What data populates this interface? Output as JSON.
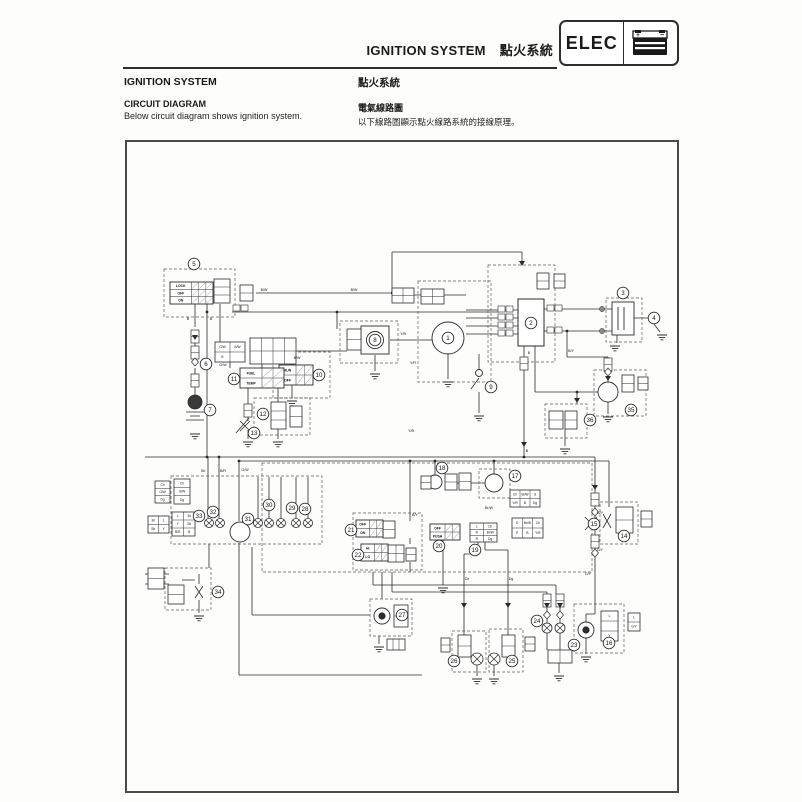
{
  "page": {
    "header": {
      "title_en": "IGNITION SYSTEM",
      "title_zh": "點火系統",
      "badge_label": "ELEC",
      "badge_icon": "battery-icon"
    },
    "intro": {
      "heading_en": "IGNITION SYSTEM",
      "subheading_en": "CIRCUIT DIAGRAM",
      "body_en": "Below circuit diagram shows ignition system.",
      "heading_zh": "點火系統",
      "subheading_zh": "電氣線路圖",
      "body_zh": "以下線路圖顯示點火線路系統的接線原理。"
    }
  },
  "diagram": {
    "ink": "#2b2b2b",
    "dash_color": "#5a5a5a",
    "callouts": [
      {
        "n": "1",
        "x": 446,
        "y": 336
      },
      {
        "n": "2",
        "x": 529,
        "y": 321
      },
      {
        "n": "3",
        "x": 621,
        "y": 291
      },
      {
        "n": "4",
        "x": 652,
        "y": 316
      },
      {
        "n": "5",
        "x": 192,
        "y": 262
      },
      {
        "n": "6",
        "x": 204,
        "y": 362
      },
      {
        "n": "7",
        "x": 208,
        "y": 408
      },
      {
        "n": "8",
        "x": 373,
        "y": 338
      },
      {
        "n": "9",
        "x": 489,
        "y": 385
      },
      {
        "n": "10",
        "x": 317,
        "y": 373
      },
      {
        "n": "11",
        "x": 232,
        "y": 377
      },
      {
        "n": "12",
        "x": 261,
        "y": 412
      },
      {
        "n": "13",
        "x": 252,
        "y": 431
      },
      {
        "n": "14",
        "x": 622,
        "y": 534
      },
      {
        "n": "15",
        "x": 592,
        "y": 522
      },
      {
        "n": "16",
        "x": 607,
        "y": 641
      },
      {
        "n": "17",
        "x": 513,
        "y": 474
      },
      {
        "n": "18",
        "x": 440,
        "y": 466
      },
      {
        "n": "19",
        "x": 473,
        "y": 548
      },
      {
        "n": "20",
        "x": 437,
        "y": 544
      },
      {
        "n": "21",
        "x": 349,
        "y": 528
      },
      {
        "n": "22",
        "x": 356,
        "y": 553
      },
      {
        "n": "23",
        "x": 572,
        "y": 643
      },
      {
        "n": "24",
        "x": 535,
        "y": 619
      },
      {
        "n": "25",
        "x": 510,
        "y": 659
      },
      {
        "n": "26",
        "x": 452,
        "y": 659
      },
      {
        "n": "27",
        "x": 400,
        "y": 613
      },
      {
        "n": "28",
        "x": 303,
        "y": 507
      },
      {
        "n": "29",
        "x": 290,
        "y": 506
      },
      {
        "n": "30",
        "x": 267,
        "y": 503
      },
      {
        "n": "31",
        "x": 246,
        "y": 517
      },
      {
        "n": "32",
        "x": 211,
        "y": 510
      },
      {
        "n": "33",
        "x": 197,
        "y": 514
      },
      {
        "n": "34",
        "x": 216,
        "y": 590
      },
      {
        "n": "35",
        "x": 629,
        "y": 408
      },
      {
        "n": "36",
        "x": 588,
        "y": 418
      }
    ],
    "switch_blocks": [
      {
        "x": 168,
        "y": 280,
        "w": 43,
        "h": 22,
        "rows": [
          "LOCK",
          "OFF",
          "ON"
        ],
        "cols": 3
      },
      {
        "x": 277,
        "y": 363,
        "w": 34,
        "h": 20,
        "rows": [
          "RUN",
          "OFF"
        ],
        "cols": 2
      },
      {
        "x": 238,
        "y": 366,
        "w": 44,
        "h": 20,
        "rows": [
          "FUEL",
          "TEMP"
        ],
        "cols": 2
      },
      {
        "x": 428,
        "y": 522,
        "w": 30,
        "h": 16,
        "rows": [
          "OFF",
          "PUSH"
        ],
        "cols": 2
      },
      {
        "x": 354,
        "y": 518,
        "w": 27,
        "h": 17,
        "rows": [
          "OFF",
          "ON"
        ],
        "cols": 2
      },
      {
        "x": 359,
        "y": 542,
        "w": 27,
        "h": 17,
        "rows": [
          "HI",
          "LO"
        ],
        "cols": 2
      }
    ],
    "grids": [
      {
        "x": 212,
        "y": 277,
        "w": 16,
        "h": 24,
        "c": 1,
        "r": 3
      },
      {
        "x": 238,
        "y": 283,
        "w": 13,
        "h": 16,
        "c": 1,
        "r": 2
      },
      {
        "x": 213,
        "y": 340,
        "w": 30,
        "h": 20,
        "c": 2,
        "r": 2,
        "labels": [
          "G/W",
          "B/W",
          "B",
          ""
        ]
      },
      {
        "x": 248,
        "y": 336,
        "w": 46,
        "h": 26,
        "c": 4,
        "r": 2
      },
      {
        "x": 390,
        "y": 286,
        "w": 22,
        "h": 15,
        "c": 2,
        "r": 2
      },
      {
        "x": 419,
        "y": 287,
        "w": 23,
        "h": 15,
        "c": 2,
        "r": 2
      },
      {
        "x": 345,
        "y": 327,
        "w": 14,
        "h": 21,
        "c": 1,
        "r": 2
      },
      {
        "x": 535,
        "y": 271,
        "w": 12,
        "h": 16,
        "c": 1,
        "r": 2
      },
      {
        "x": 552,
        "y": 272,
        "w": 11,
        "h": 14,
        "c": 1,
        "r": 2
      },
      {
        "x": 443,
        "y": 472,
        "w": 12,
        "h": 16,
        "c": 1,
        "r": 2
      },
      {
        "x": 457,
        "y": 471,
        "w": 12,
        "h": 17,
        "c": 1,
        "r": 2
      },
      {
        "x": 419,
        "y": 474,
        "w": 10,
        "h": 13,
        "c": 1,
        "r": 2
      },
      {
        "x": 508,
        "y": 488,
        "w": 30,
        "h": 17,
        "c": 3,
        "r": 2,
        "labels": [
          "Ch",
          "Br/W",
          "G",
          "Y/R",
          "B",
          "Dg"
        ]
      },
      {
        "x": 510,
        "y": 516,
        "w": 31,
        "h": 20,
        "c": 3,
        "r": 2,
        "labels": [
          "O",
          "Br/W",
          "Ch",
          "P",
          "B",
          "Y/R"
        ]
      },
      {
        "x": 468,
        "y": 521,
        "w": 27,
        "h": 19,
        "c": 2,
        "r": 3,
        "labels": [
          "L",
          "Ch",
          "N",
          "Br/W",
          "R",
          "Dg"
        ]
      },
      {
        "x": 381,
        "y": 519,
        "w": 12,
        "h": 17,
        "c": 1,
        "r": 2
      },
      {
        "x": 386,
        "y": 543,
        "w": 16,
        "h": 17,
        "c": 2,
        "r": 2
      },
      {
        "x": 404,
        "y": 546,
        "w": 10,
        "h": 13,
        "c": 1,
        "r": 2
      },
      {
        "x": 153,
        "y": 479,
        "w": 15,
        "h": 22,
        "c": 1,
        "r": 3,
        "labels": [
          "Ch",
          "G/W",
          "Dg"
        ]
      },
      {
        "x": 172,
        "y": 477,
        "w": 16,
        "h": 25,
        "c": 1,
        "r": 3,
        "labels": [
          "Ch",
          "G/W",
          "Dg"
        ]
      },
      {
        "x": 146,
        "y": 514,
        "w": 21,
        "h": 17,
        "c": 2,
        "r": 2,
        "labels": [
          "Br",
          "L",
          "Sb",
          "Y"
        ]
      },
      {
        "x": 170,
        "y": 510,
        "w": 23,
        "h": 24,
        "c": 2,
        "r": 3,
        "labels": [
          "L",
          "Br",
          "Y",
          "Sb",
          "B/R",
          "B"
        ]
      },
      {
        "x": 146,
        "y": 566,
        "w": 16,
        "h": 21,
        "c": 1,
        "r": 2
      },
      {
        "x": 166,
        "y": 583,
        "w": 16,
        "h": 19,
        "c": 1,
        "r": 2
      },
      {
        "x": 614,
        "y": 505,
        "w": 17,
        "h": 26,
        "c": 1,
        "r": 2
      },
      {
        "x": 639,
        "y": 509,
        "w": 11,
        "h": 16,
        "c": 1,
        "r": 2
      },
      {
        "x": 599,
        "y": 609,
        "w": 17,
        "h": 30,
        "c": 1,
        "r": 3,
        "labels": [
          "L",
          "",
          "Y"
        ]
      },
      {
        "x": 626,
        "y": 611,
        "w": 12,
        "h": 18,
        "c": 1,
        "r": 2,
        "labels": [
          "L",
          "G/Y"
        ]
      },
      {
        "x": 620,
        "y": 373,
        "w": 12,
        "h": 17,
        "c": 1,
        "r": 2
      },
      {
        "x": 636,
        "y": 375,
        "w": 10,
        "h": 13,
        "c": 1,
        "r": 2
      },
      {
        "x": 547,
        "y": 409,
        "w": 14,
        "h": 18,
        "c": 1,
        "r": 2
      },
      {
        "x": 563,
        "y": 409,
        "w": 12,
        "h": 18,
        "c": 1,
        "r": 2
      },
      {
        "x": 500,
        "y": 633,
        "w": 13,
        "h": 22,
        "c": 1,
        "r": 2
      },
      {
        "x": 523,
        "y": 635,
        "w": 10,
        "h": 14,
        "c": 1,
        "r": 2
      },
      {
        "x": 456,
        "y": 633,
        "w": 13,
        "h": 22,
        "c": 1,
        "r": 2
      },
      {
        "x": 439,
        "y": 636,
        "w": 9,
        "h": 14,
        "c": 1,
        "r": 2
      },
      {
        "x": 392,
        "y": 603,
        "w": 14,
        "h": 22,
        "c": 1,
        "r": 2
      },
      {
        "x": 546,
        "y": 648,
        "w": 24,
        "h": 13,
        "c": 2,
        "r": 1
      },
      {
        "x": 269,
        "y": 400,
        "w": 15,
        "h": 27,
        "c": 1,
        "r": 3
      },
      {
        "x": 288,
        "y": 404,
        "w": 12,
        "h": 21,
        "c": 1,
        "r": 2
      },
      {
        "x": 385,
        "y": 637,
        "w": 18,
        "h": 11,
        "c": 3,
        "r": 1
      }
    ],
    "dashed_boxes": [
      [
        162,
        267,
        71,
        48
      ],
      [
        486,
        263,
        67,
        97
      ],
      [
        604,
        296,
        36,
        44
      ],
      [
        416,
        279,
        73,
        101
      ],
      [
        338,
        319,
        58,
        42
      ],
      [
        271,
        350,
        57,
        46
      ],
      [
        252,
        396,
        56,
        37
      ],
      [
        169,
        474,
        151,
        68
      ],
      [
        260,
        461,
        330,
        109
      ],
      [
        351,
        511,
        69,
        57
      ],
      [
        477,
        467,
        31,
        29
      ],
      [
        598,
        500,
        38,
        42
      ],
      [
        572,
        602,
        50,
        49
      ],
      [
        592,
        368,
        52,
        46
      ],
      [
        543,
        402,
        42,
        34
      ],
      [
        487,
        627,
        34,
        43
      ],
      [
        450,
        629,
        34,
        41
      ],
      [
        368,
        597,
        42,
        37
      ],
      [
        163,
        566,
        46,
        42
      ]
    ],
    "bulbs_x": [
      [
        207,
        521,
        4.5
      ],
      [
        218,
        521,
        4.5
      ],
      [
        256,
        521,
        4.5
      ],
      [
        267,
        521,
        4.5
      ],
      [
        279,
        521,
        4.5
      ],
      [
        294,
        521,
        4.5
      ],
      [
        306,
        521,
        4.5
      ],
      [
        475,
        657,
        6
      ],
      [
        492,
        657,
        6
      ],
      [
        545,
        626,
        5
      ],
      [
        558,
        626,
        5
      ]
    ],
    "bulbs_fil": [
      [
        584,
        628,
        8
      ],
      [
        380,
        614,
        8
      ]
    ],
    "comp_circles": [
      [
        446,
        336,
        16
      ],
      [
        373,
        338,
        8.5
      ],
      [
        492,
        481,
        9
      ],
      [
        433,
        480,
        7
      ],
      [
        606,
        390,
        10
      ],
      [
        238,
        530,
        10
      ],
      [
        477,
        371,
        3.5
      ]
    ],
    "battery": [
      193,
      400,
      7
    ],
    "grounds": [
      [
        193,
        432
      ],
      [
        246,
        440
      ],
      [
        276,
        440
      ],
      [
        290,
        399
      ],
      [
        373,
        372
      ],
      [
        446,
        380
      ],
      [
        477,
        414
      ],
      [
        613,
        344
      ],
      [
        660,
        333
      ],
      [
        606,
        415
      ],
      [
        563,
        447
      ],
      [
        197,
        614
      ],
      [
        441,
        586
      ],
      [
        377,
        645
      ],
      [
        475,
        677
      ],
      [
        492,
        677
      ],
      [
        557,
        674
      ],
      [
        584,
        655
      ]
    ],
    "diamonds": [
      [
        193,
        360
      ],
      [
        606,
        370
      ],
      [
        593,
        510
      ],
      [
        593,
        551
      ],
      [
        545,
        613
      ],
      [
        558,
        613
      ]
    ],
    "fuses": [
      [
        189,
        328
      ],
      [
        189,
        344
      ],
      [
        189,
        372
      ],
      [
        518,
        355
      ],
      [
        602,
        356
      ],
      [
        589,
        491
      ],
      [
        589,
        533
      ],
      [
        541,
        592
      ],
      [
        554,
        592
      ],
      [
        242,
        402
      ]
    ],
    "arrows": [
      [
        520,
        259
      ],
      [
        193,
        333
      ],
      [
        522,
        440
      ],
      [
        593,
        483
      ],
      [
        545,
        601
      ],
      [
        558,
        601
      ],
      [
        462,
        601
      ],
      [
        506,
        601
      ],
      [
        606,
        374
      ],
      [
        575,
        396
      ]
    ],
    "dots": [
      [
        205,
        310
      ],
      [
        335,
        310
      ],
      [
        390,
        291
      ],
      [
        205,
        455
      ],
      [
        217,
        455
      ],
      [
        237,
        459
      ],
      [
        522,
        455
      ],
      [
        565,
        329
      ],
      [
        575,
        390
      ],
      [
        433,
        459
      ],
      [
        408,
        459
      ],
      [
        492,
        459
      ]
    ],
    "pair_squares": [
      [
        496,
        304
      ],
      [
        504,
        304
      ],
      [
        496,
        312
      ],
      [
        504,
        312
      ],
      [
        496,
        320
      ],
      [
        504,
        320
      ],
      [
        496,
        328
      ],
      [
        504,
        328
      ],
      [
        545,
        303
      ],
      [
        553,
        303
      ],
      [
        545,
        325
      ],
      [
        553,
        325
      ],
      [
        231,
        303
      ],
      [
        239,
        303
      ]
    ],
    "terminals": [
      [
        600,
        307
      ],
      [
        600,
        329
      ]
    ],
    "wire_labels": [
      {
        "t": "B/W",
        "x": 262,
        "y": 289
      },
      {
        "t": "B/W",
        "x": 352,
        "y": 289
      },
      {
        "t": "B",
        "x": 186,
        "y": 318
      },
      {
        "t": "B",
        "x": 209,
        "y": 318
      },
      {
        "t": "G/W",
        "x": 221,
        "y": 364
      },
      {
        "t": "Y/B",
        "x": 401,
        "y": 333
      },
      {
        "t": "Y/R",
        "x": 411,
        "y": 362
      },
      {
        "t": "B",
        "x": 527,
        "y": 352
      },
      {
        "t": "B/Y",
        "x": 569,
        "y": 350
      },
      {
        "t": "Sb",
        "x": 201,
        "y": 470
      },
      {
        "t": "B/R",
        "x": 221,
        "y": 470
      },
      {
        "t": "G/W",
        "x": 243,
        "y": 469
      },
      {
        "t": "Ch",
        "x": 465,
        "y": 578
      },
      {
        "t": "Dg",
        "x": 509,
        "y": 578
      },
      {
        "t": "G/Y",
        "x": 598,
        "y": 512
      },
      {
        "t": "G/Y",
        "x": 598,
        "y": 549
      },
      {
        "t": "G/Y",
        "x": 586,
        "y": 573
      },
      {
        "t": "Br/W",
        "x": 487,
        "y": 507
      },
      {
        "t": "Y/B",
        "x": 409,
        "y": 430
      },
      {
        "t": "B",
        "x": 525,
        "y": 450
      },
      {
        "t": "B/Y",
        "x": 413,
        "y": 514
      },
      {
        "t": "B/W",
        "x": 295,
        "y": 357
      }
    ]
  }
}
